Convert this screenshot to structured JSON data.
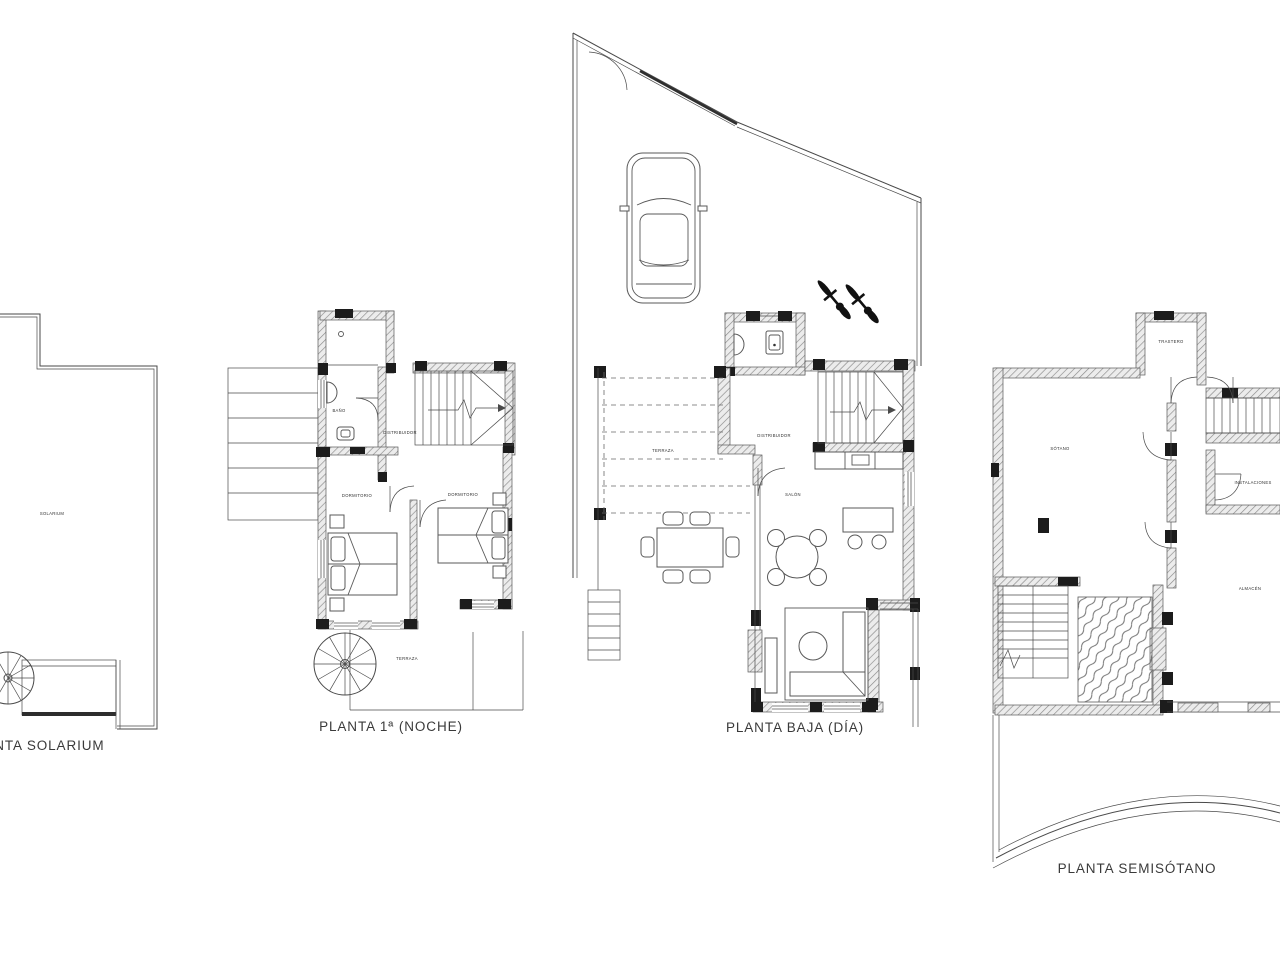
{
  "document": {
    "type": "architectural-floor-plan-sheet",
    "background_color": "#ffffff",
    "ink_color": "#4a4a4a",
    "wall_hatch_color": "#8a8a8a",
    "pillar_color": "#1c1c1c"
  },
  "plans": {
    "solarium": {
      "title": "PLANTA SOLARIUM",
      "rooms": {
        "solarium": "SOLARIUM"
      }
    },
    "first_floor": {
      "title": "PLANTA 1ª (NOCHE)",
      "rooms": {
        "bano": "BAÑO",
        "distribuidor": "DISTRIBUIDOR",
        "dormitorio_left": "DORMITORIO",
        "dormitorio_right": "DORMITORIO",
        "terraza": "TERRAZA"
      }
    },
    "ground_floor": {
      "title": "PLANTA BAJA (DÍA)",
      "rooms": {
        "terraza": "TERRAZA",
        "distribuidor": "DISTRIBUIDOR",
        "salon": "SALÓN"
      }
    },
    "basement": {
      "title": "PLANTA SEMISÓTANO",
      "rooms": {
        "trastero": "TRASTERO",
        "sotano": "SÓTANO",
        "instalaciones": "INSTALACIONES",
        "almacen": "ALMACÉN"
      }
    }
  }
}
